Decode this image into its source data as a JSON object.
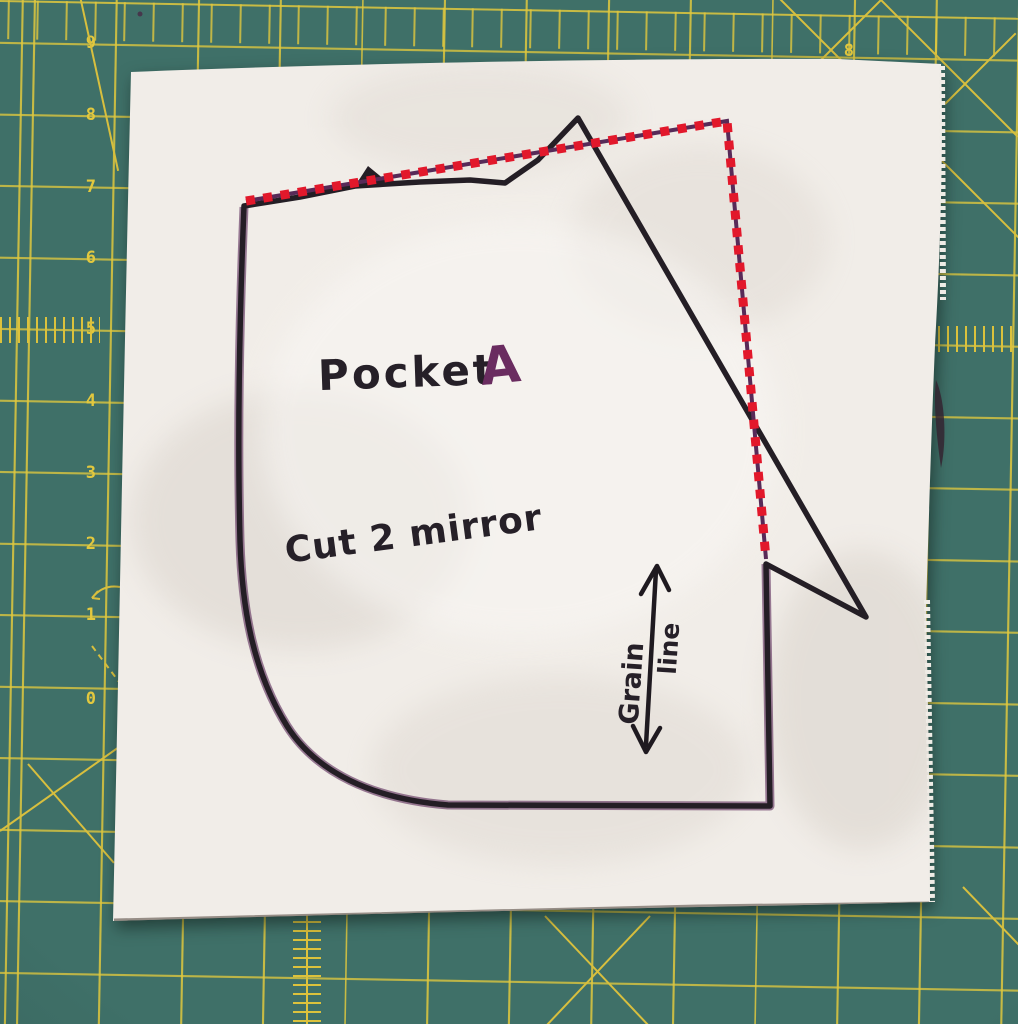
{
  "mat": {
    "surface_color": "#3f7068",
    "grid_color": "#dcc23c",
    "left_ruler_numbers": [
      "9",
      "8",
      "7",
      "6",
      "5",
      "4",
      "3",
      "2",
      "1",
      "0"
    ],
    "top_edge_number": "8"
  },
  "pattern": {
    "piece_name": "Pocket",
    "piece_letter": "A",
    "cutting_instruction": "Cut 2 mirror",
    "grainline_word_1": "Grain",
    "grainline_word_2": "line",
    "ink_color": "#241e25",
    "traced_purple": "#5a2a58",
    "seam_line_red": "#e2182b"
  }
}
